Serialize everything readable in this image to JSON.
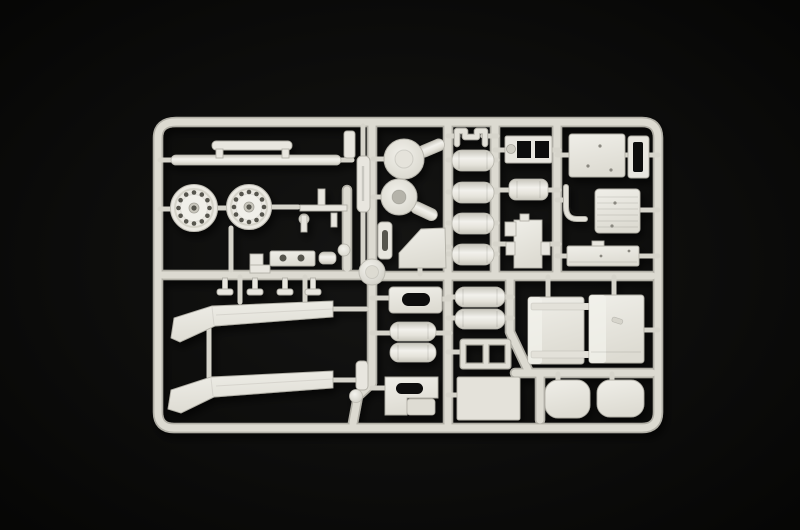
{
  "image": {
    "kind": "photograph",
    "subject": "Injection-molded model kit sprue with white styrene parts on a black backdrop",
    "background": "plain black studio backdrop",
    "visible_text": ""
  },
  "palette": {
    "backdrop": "#090908",
    "vignette_center": "#161615",
    "plastic_base": "#e8e6df",
    "plastic_highlight": "#f3f2ed",
    "plastic_shadow": "#b2b0a7",
    "runner_face": "#dcdad1",
    "hole_dark": "#56544e"
  },
  "sprue": {
    "layout": "rounded rectangular outer frame with vertical and horizontal internal runners; parts arranged in two halves",
    "parts": [
      {
        "name": "wheel hub with bolt-hole ring",
        "count": 2
      },
      {
        "name": "front bumper bar",
        "count": 1
      },
      {
        "name": "bumper mounting bracket",
        "count": 1
      },
      {
        "name": "long chassis fairing strip",
        "count": 2
      },
      {
        "name": "round filter housing with stem",
        "count": 2
      },
      {
        "name": "small cylindrical tank",
        "count": 4
      },
      {
        "name": "large cylindrical air tank",
        "count": 4
      },
      {
        "name": "plate with oval cutout",
        "count": 2
      },
      {
        "name": "mud flap panel",
        "count": 1
      },
      {
        "name": "window instrument frame",
        "count": 1
      },
      {
        "name": "ribbed radiator panel",
        "count": 1
      },
      {
        "name": "riveted roof panel",
        "count": 1
      },
      {
        "name": "narrow door frame ring",
        "count": 1
      },
      {
        "name": "riveted sleeper side panel",
        "count": 1
      },
      {
        "name": "cab door",
        "count": 2
      },
      {
        "name": "seat cushion",
        "count": 2
      },
      {
        "name": "flat floor panel",
        "count": 1
      },
      {
        "name": "ladder sub-frame",
        "count": 1
      },
      {
        "name": "engine block with side tabs",
        "count": 1
      },
      {
        "name": "rounded reservoir block",
        "count": 1
      },
      {
        "name": "J-shaped bracket",
        "count": 1
      },
      {
        "name": "U-shaped clamp",
        "count": 1
      },
      {
        "name": "assorted small brackets and pins",
        "count": 8
      },
      {
        "name": "injection gate knob",
        "count": 2
      }
    ]
  }
}
